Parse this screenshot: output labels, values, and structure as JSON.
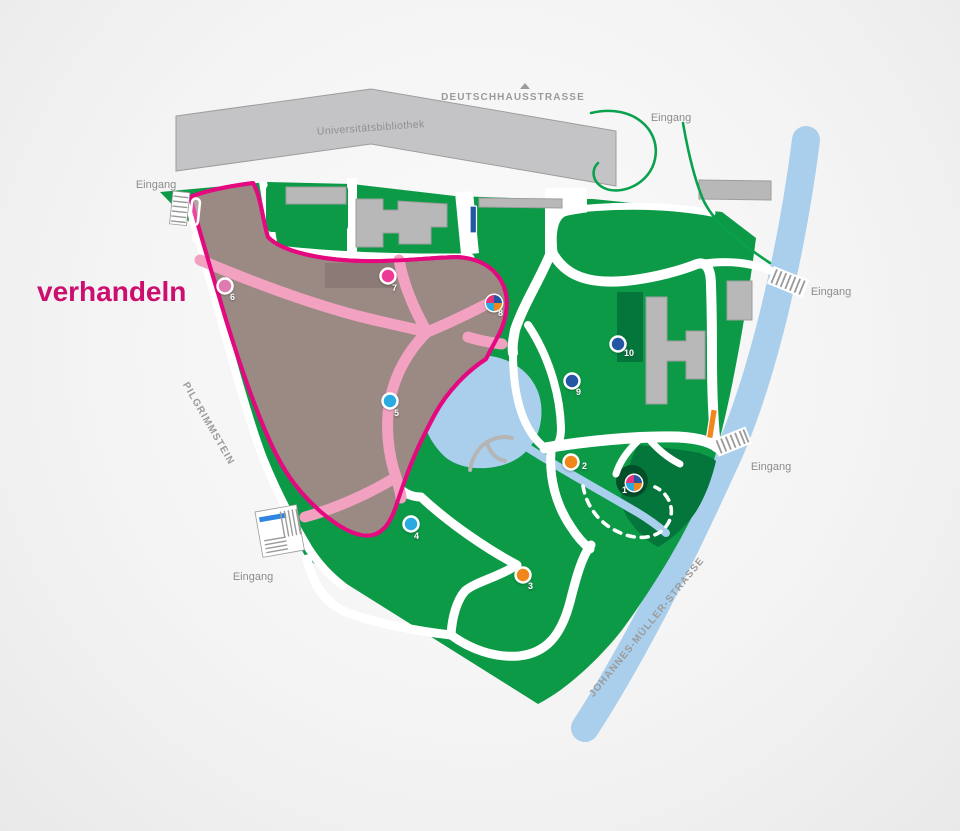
{
  "title": {
    "text": "verhandeln"
  },
  "palette": {
    "park-green": "#0c9a47",
    "dark-green": "#04763b",
    "darkest-green": "#034f2a",
    "water": "#a9cfec",
    "building-gray": "#b8b8b8",
    "library-gray": "#c4c4c6",
    "area-mauve": "#9b8984",
    "area-mauve-dark": "#8b7a76",
    "path-pink": "#f2a2c0",
    "outline-magenta": "#e5097f",
    "title-magenta": "#cc0e6e",
    "street-gray": "#9b9b9b",
    "entrance-gray": "#8c8c8c",
    "path-green-line": "#0aa14e",
    "bar-orange": "#f1861b",
    "bar-blue": "#2456a4",
    "stair-blue": "#2e86e0"
  },
  "map": {
    "streets": {
      "top": "DEUTSCHHAUSSTRASSE",
      "left": "PILGRIMMSTEIN",
      "right": "JOHANNES-MÜLLER-STRASSE"
    },
    "buildings": {
      "library": "Universitätsbibliothek"
    },
    "entrances": [
      {
        "label": "Eingang",
        "position": "top-left"
      },
      {
        "label": "Eingang",
        "position": "top-right"
      },
      {
        "label": "Eingang",
        "position": "right-upper"
      },
      {
        "label": "Eingang",
        "position": "right-lower"
      },
      {
        "label": "Eingang",
        "position": "bottom-left"
      }
    ],
    "markers": [
      {
        "number": "1",
        "type": "multi",
        "colors": [
          "#e6317e",
          "#2456a4",
          "#f1861b",
          "#29abe2"
        ]
      },
      {
        "number": "2",
        "type": "single",
        "color": "#f1861b"
      },
      {
        "number": "3",
        "type": "single",
        "color": "#f1861b"
      },
      {
        "number": "4",
        "type": "single",
        "color": "#29abe2"
      },
      {
        "number": "5",
        "type": "single",
        "color": "#29abe2"
      },
      {
        "number": "6",
        "type": "single",
        "color": "#df7bb0"
      },
      {
        "number": "7",
        "type": "single",
        "color": "#ee3a97"
      },
      {
        "number": "8",
        "type": "multi",
        "colors": [
          "#e6317e",
          "#2456a4",
          "#f1861b",
          "#29abe2"
        ]
      },
      {
        "number": "9",
        "type": "single",
        "color": "#2456a4"
      },
      {
        "number": "10",
        "type": "single",
        "color": "#2456a4"
      }
    ]
  }
}
